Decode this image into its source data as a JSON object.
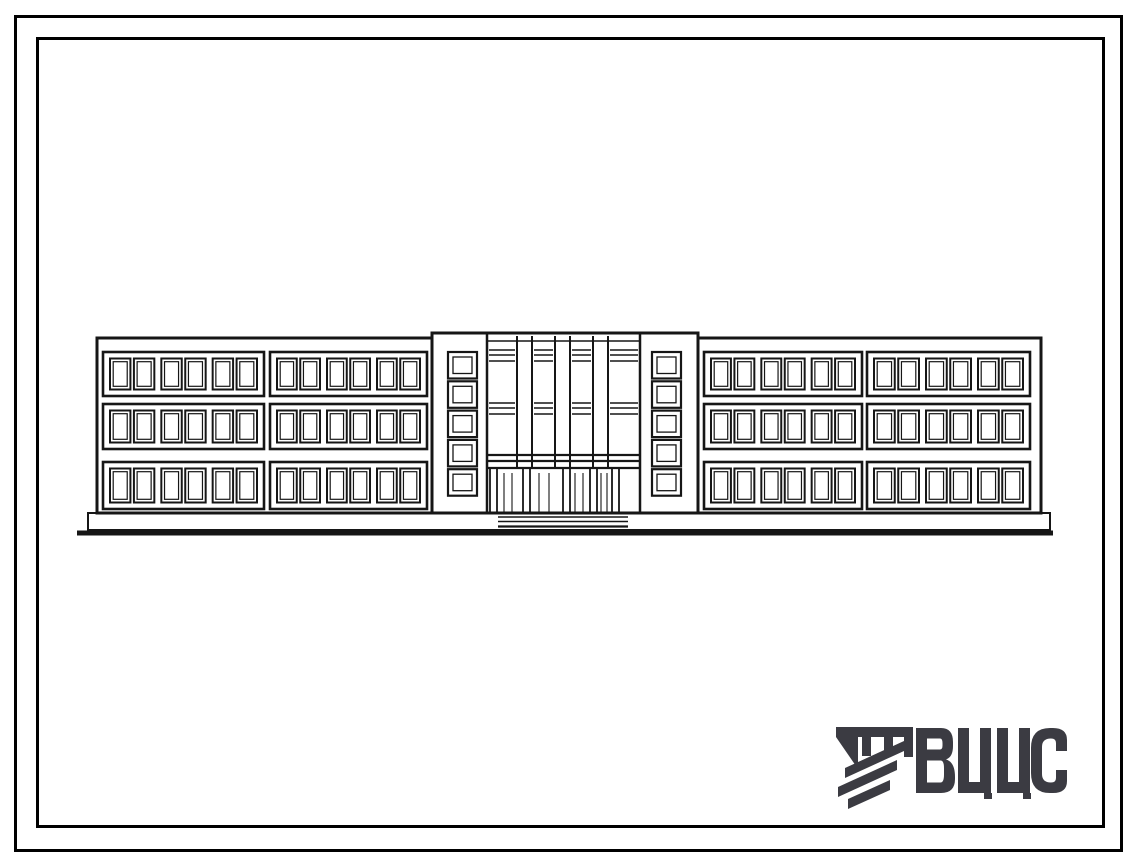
{
  "sheet": {
    "background": "#ffffff",
    "outer_border_color": "#000000",
    "inner_border_color": "#000000"
  },
  "facade": {
    "description": "Front elevation of a long three-storey building: two window wings, two stair towers with five small square windows each, a central glazed entrance bay with four vertical glazing strips, a four-opening entrance door and steps at ground level",
    "line_color": "#161616",
    "floors": 3,
    "wings": 2,
    "window_bands_per_floor_per_wing": 2,
    "window_pairs_per_band": 3,
    "windows_per_band": 6,
    "towers": 2,
    "tower_small_windows_per_tower": 5,
    "center_glazing_columns": 4,
    "center_piers": 3,
    "entrance_door_openings": 4
  },
  "logo": {
    "text": "ВЦИС",
    "color": "#3b3b42",
    "emblem": "diagonal-hatched-beam-mark"
  }
}
